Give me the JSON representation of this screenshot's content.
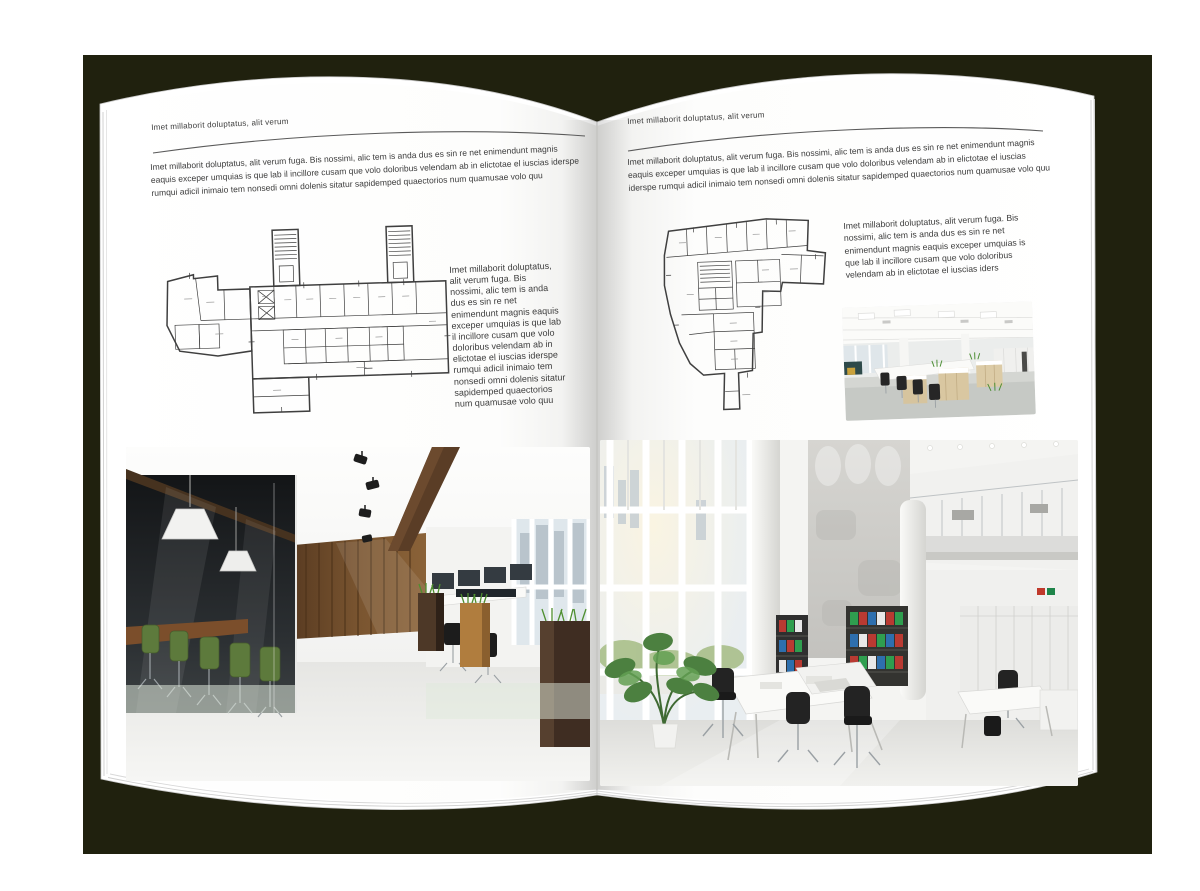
{
  "backdrop": {
    "color": "#20210e"
  },
  "book": {
    "left_page": {
      "header": "Imet millaborit doluptatus, alit verum",
      "intro": "Imet millaborit doluptatus, alit verum fuga. Bis nossimi, alic tem is anda dus es sin re net enimendunt magnis eaquis exceper umquias is que lab il incillore cusam que volo doloribus velendam ab in elictotae el iuscias iderspe rumqui adicil inimaio tem nonsedi omni dolenis sitatur sapidemped quaectorios num quamusae volo quu",
      "side_text": "Imet millaborit doluptatus, alit verum fuga. Bis nossimi, alic tem is anda dus es sin re net enimendunt magnis eaquis exceper umquias is que lab il incillore cusam que volo doloribus velendam ab in elictotae el iuscias iderspe rumqui adicil inimaio tem nonsedi omni dolenis sitatur sapidemped quaectorios num quamusae volo quu"
    },
    "right_page": {
      "header": "Imet millaborit doluptatus, alit verum",
      "intro": "Imet millaborit doluptatus, alit verum fuga. Bis nossimi, alic tem is anda dus es sin re net enimendunt magnis eaquis exceper umquias is que lab il incillore cusam que volo doloribus velendam ab in elictotae el iuscias iderspe rumqui adicil inimaio tem nonsedi omni dolenis sitatur sapidemped quaectorios num quamusae volo quu",
      "side_text": "Imet millaborit doluptatus, alit verum fuga. Bis nossimi, alic tem is anda dus es sin re net enimendunt magnis eaquis exceper umquias is que lab il incillore cusam que volo doloribus velendam ab in elictotae el iuscias iders"
    }
  },
  "palette": {
    "page_white": "#ffffff",
    "text_gray": "#3c3c3c",
    "rule_gray": "#5a5a5a",
    "plan_line": "#3f3f3f",
    "wood_dark": "#4a3323",
    "wood_light": "#b07d3e",
    "chair_green": "#5d7a3c",
    "grass_green": "#4e8f2f",
    "binder_red": "#b93a32",
    "binder_green": "#2f9e4f",
    "binder_blue": "#2e6fae",
    "concrete_gray": "#cdccc8",
    "window_sky": "#e9eef1"
  }
}
